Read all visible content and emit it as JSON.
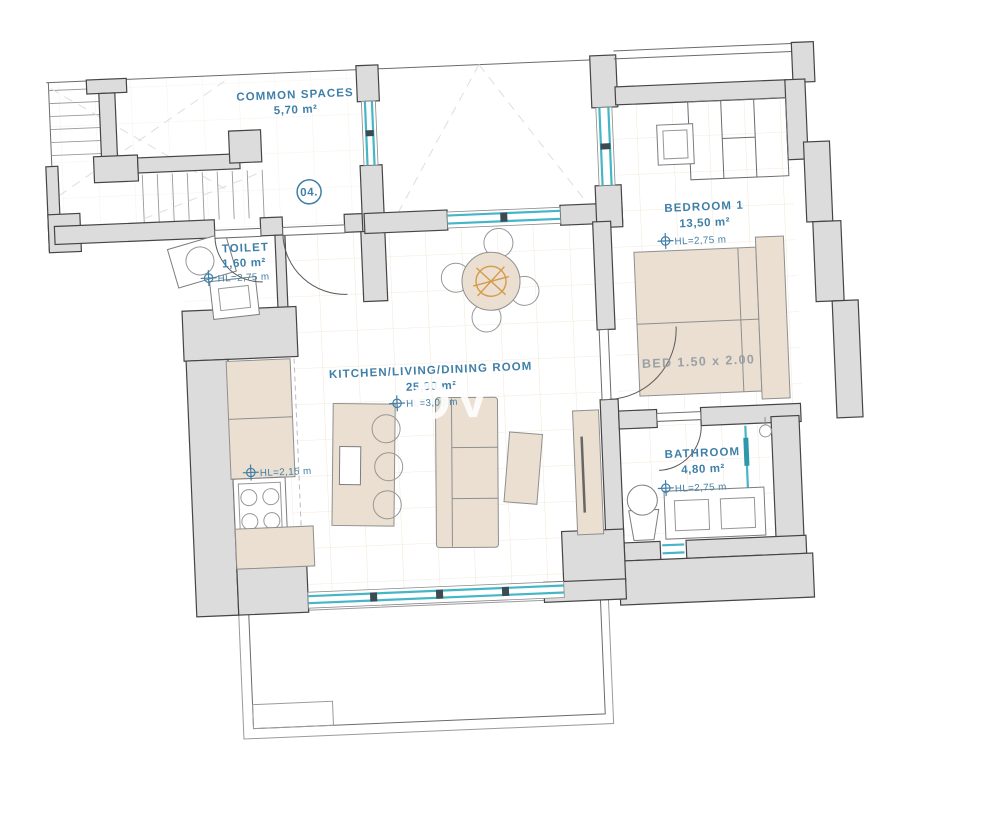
{
  "colors": {
    "wall-fill": "#dcdcdc",
    "wall-stroke": "#454545",
    "window": "#45b6c5",
    "furniture": "#eadfd0",
    "furniture-stroke": "#8f8f8f",
    "label": "#3f7fa8",
    "grid": "#ead9bf",
    "accent": "#d79a4a",
    "bed-label": "#9aa0a6"
  },
  "plan": {
    "unit_number": "04.",
    "watermark": "OV",
    "common": {
      "name": "COMMON SPACES",
      "area": "5,70 m²"
    },
    "toilet": {
      "name": "TOILET",
      "area": "1,60 m²",
      "ceiling": "HL=2,75 m"
    },
    "bedroom": {
      "name": "BEDROOM 1",
      "area": "13,50 m²",
      "ceiling": "HL=2,75 m",
      "bed": "BED 1.50 x 2.00"
    },
    "living": {
      "name": "KITCHEN/LIVING/DINING ROOM",
      "area": "25,90 m²",
      "ceiling": "HL=3,00 m",
      "kitchen_ceiling": "HL=2,15 m"
    },
    "bathroom": {
      "name": "BATHROOM",
      "area": "4,80 m²",
      "ceiling": "HL=2,75 m"
    }
  }
}
